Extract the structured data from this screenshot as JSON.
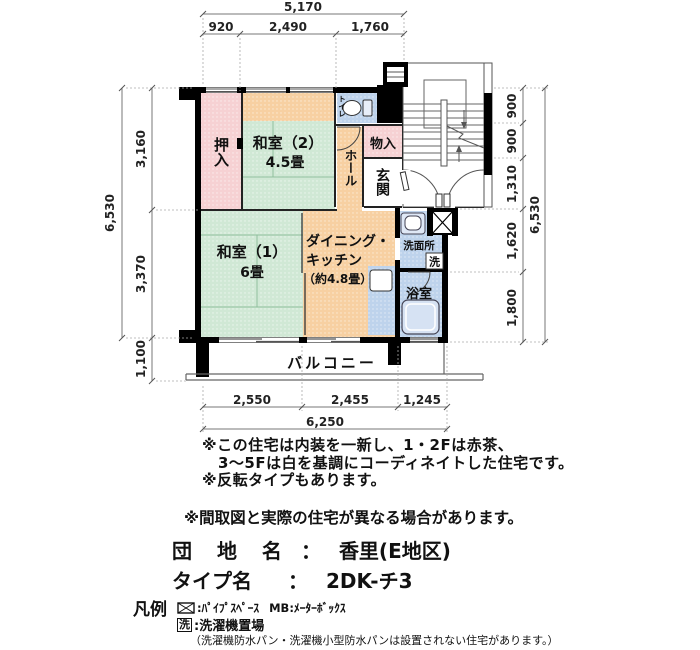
{
  "colors": {
    "pink": "#f6d1d3",
    "green": "#d0e8d5",
    "orange": "#f7d0a2",
    "blue": "#bed3ec",
    "wall": "#000000",
    "dim_line": "#777777"
  },
  "plan": {
    "rooms": {
      "oshiire": "押入",
      "washitsu2": "和室（2）",
      "washitsu2_size": "4.5畳",
      "toilet": "トイレ",
      "monoire": "物入",
      "hall": "ホール",
      "genkan": "玄関",
      "washitsu1": "和室（1）",
      "washitsu1_size": "6畳",
      "dk_line1": "ダイニング・",
      "dk_line2": "キッチン",
      "dk_size": "（約4.8畳）",
      "senmenjo": "洗面所",
      "washer_mark": "洗",
      "bath": "浴室",
      "balcony": "バルコニー"
    },
    "dims": {
      "top_total": "5,170",
      "top": [
        "920",
        "2,490",
        "1,760"
      ],
      "left": [
        "3,160",
        "3,370",
        "1,100"
      ],
      "left_total": "6,530",
      "right": [
        "900",
        "900",
        "1,310",
        "1,620",
        "1,800"
      ],
      "right_total": "6,530",
      "bottom": [
        "2,550",
        "2,455",
        "1,245"
      ],
      "bottom_total": "6,250"
    }
  },
  "notes": {
    "line1": "※この住宅は内装を一新し、1・2Fは赤茶、",
    "line2": "3〜5Fは白を基調にコーディネイトした住宅です。",
    "line3": "※反転タイプもあります。",
    "disclaimer": "※間取図と実際の住宅が異なる場合があります。"
  },
  "info": {
    "danchi_label": "団 地 名",
    "separator": "：",
    "danchi_value": "香里(E地区)",
    "type_label": "タイプ名",
    "type_value": "2DK-チ3"
  },
  "legend": {
    "title": "凡例",
    "pipe_text": ":ﾊﾟｲﾌﾟｽﾍﾟｰｽ",
    "mb_text": "MB:ﾒｰﾀｰﾎﾞｯｸｽ",
    "washer_symbol": "洗",
    "washer_text": ":洗濯機置場",
    "washer_note": "（洗濯機防水パン・洗濯機小型防水パンは設置されない住宅があります。）"
  }
}
